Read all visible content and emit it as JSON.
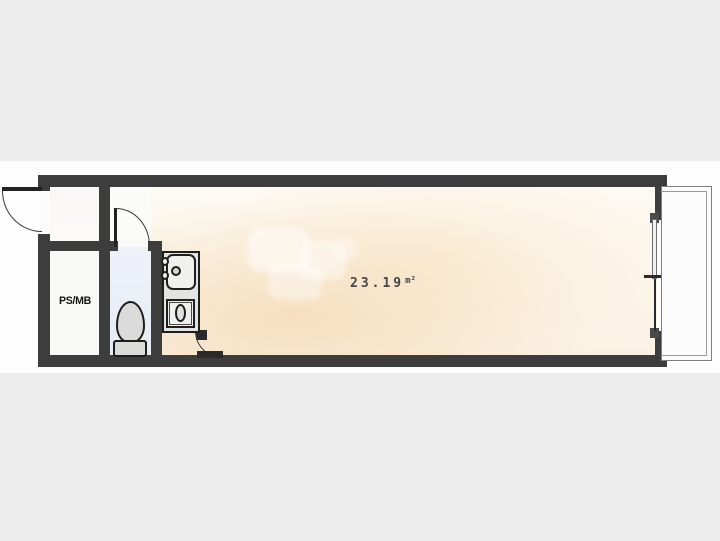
{
  "floorplan": {
    "ps_mb_label": "PS/MB",
    "area_value": "23.19",
    "area_unit": "m²",
    "fixtures": [
      "entrance-door",
      "toilet",
      "kitchen-sink",
      "gas-stove",
      "sliding-window",
      "balcony"
    ],
    "colors": {
      "background": "#ededed",
      "paper": "#fdfdfd",
      "wall": "#3d3d3d",
      "room_warm_light": "#fdfaf3",
      "room_warm_deep": "#f6debe",
      "toilet_room": "#eaeef5",
      "kitchen_counter": "#e3e3e1",
      "fixture_fill": "#dbdbd9",
      "balcony_line": "#7e7e7e"
    }
  }
}
